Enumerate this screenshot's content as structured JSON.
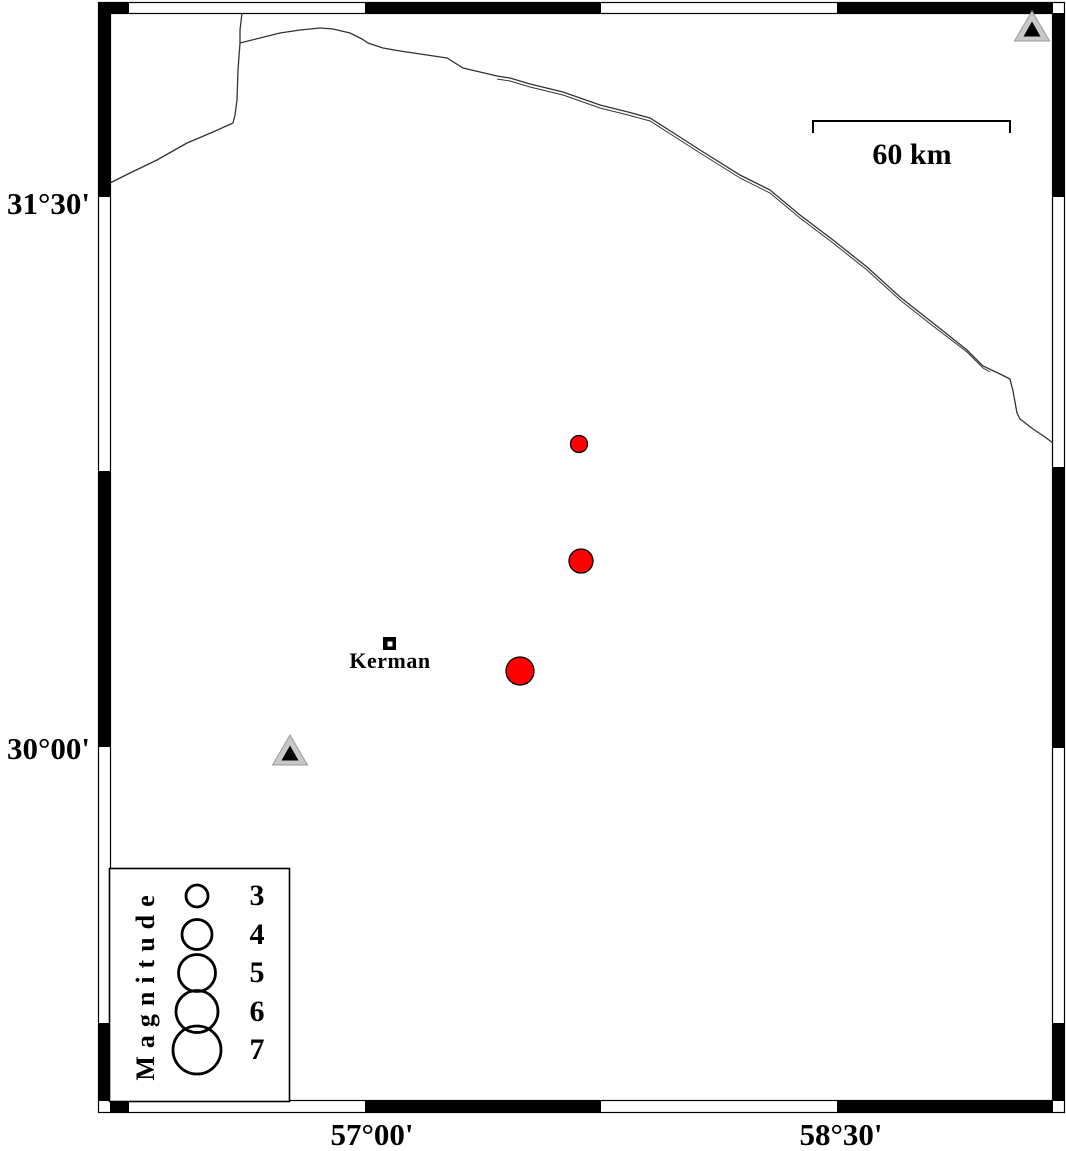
{
  "map": {
    "lat_labels": [
      {
        "text": "31°30'"
      },
      {
        "text": "30°00'"
      }
    ],
    "lon_labels": [
      {
        "text": "57°00'"
      },
      {
        "text": "58°30'"
      }
    ],
    "scale_bar": {
      "label": "60 km"
    },
    "city": {
      "name": "Kerman"
    },
    "legend": {
      "title": "Magnitude",
      "entries": [
        {
          "label": "3",
          "r": 11
        },
        {
          "label": "4",
          "r": 15
        },
        {
          "label": "5",
          "r": 18.5
        },
        {
          "label": "6",
          "r": 21
        },
        {
          "label": "7",
          "r": 24
        }
      ]
    },
    "colors": {
      "earthquake_fill": "#ff0000",
      "station_fill": "#c8c8c8",
      "station_edge": "#9a9a9a",
      "station_inner": "#000000",
      "outline": "#000000",
      "border_line": "#333333"
    },
    "earthquakes": [
      {
        "px": 579,
        "py": 444,
        "r": 8.5
      },
      {
        "px": 581,
        "py": 561,
        "r": 12
      },
      {
        "px": 520,
        "py": 671,
        "r": 14
      }
    ],
    "stations": [
      {
        "px": 290,
        "py": 751
      },
      {
        "px": 1032,
        "py": 27
      }
    ]
  }
}
